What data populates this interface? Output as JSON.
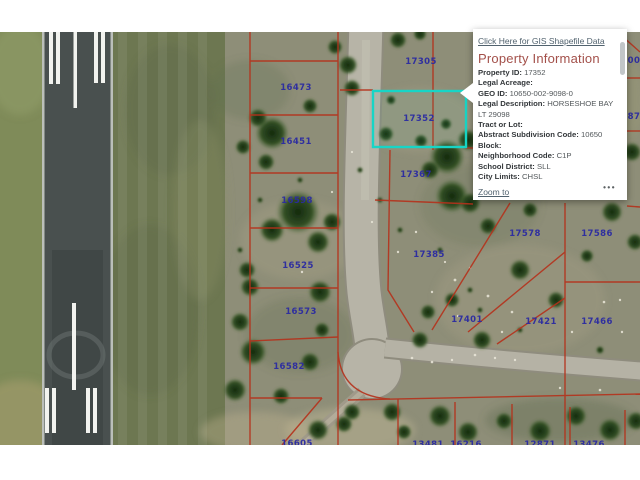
{
  "map": {
    "top_link": {
      "label": "Click Here for GIS Shapefile Data"
    },
    "highlight_color": "#17d5c6",
    "parcel_line_color": "#b5311b",
    "label_color": "#2b2ba2",
    "parcel_labels": [
      {
        "text": "16426",
        "x": 281,
        "y": 30
      },
      {
        "text": "16473",
        "x": 296,
        "y": 88
      },
      {
        "text": "16451",
        "x": 296,
        "y": 142
      },
      {
        "text": "16598",
        "x": 297,
        "y": 201
      },
      {
        "text": "16525",
        "x": 298,
        "y": 266
      },
      {
        "text": "16573",
        "x": 301,
        "y": 312
      },
      {
        "text": "16582",
        "x": 289,
        "y": 367
      },
      {
        "text": "16605",
        "x": 297,
        "y": 444
      },
      {
        "text": "17305",
        "x": 421,
        "y": 62
      },
      {
        "text": "17352",
        "x": 419,
        "y": 119
      },
      {
        "text": "17367",
        "x": 416,
        "y": 175
      },
      {
        "text": "17385",
        "x": 429,
        "y": 255
      },
      {
        "text": "17578",
        "x": 525,
        "y": 234
      },
      {
        "text": "17586",
        "x": 597,
        "y": 234
      },
      {
        "text": "17401",
        "x": 467,
        "y": 320
      },
      {
        "text": "17421",
        "x": 541,
        "y": 322
      },
      {
        "text": "17466",
        "x": 597,
        "y": 322
      },
      {
        "text": "00",
        "x": 634,
        "y": 61
      },
      {
        "text": "87",
        "x": 634,
        "y": 117
      },
      {
        "text": "13481",
        "x": 428,
        "y": 445
      },
      {
        "text": "16216",
        "x": 466,
        "y": 445
      },
      {
        "text": "12871",
        "x": 540,
        "y": 445
      },
      {
        "text": "13476",
        "x": 589,
        "y": 445
      }
    ]
  },
  "popup": {
    "title": "Property Information",
    "fields": [
      {
        "label": "Property ID:",
        "value": "17352"
      },
      {
        "label": "Legal Acreage:",
        "value": ""
      },
      {
        "label": "GEO ID:",
        "value": "10650-002-9098-0"
      },
      {
        "label": "Legal Description:",
        "value": "HORSESHOE BAY LT 29098"
      },
      {
        "label": "Tract or Lot:",
        "value": ""
      },
      {
        "label": "Abstract Subdivision Code:",
        "value": "10650"
      },
      {
        "label": "Block:",
        "value": ""
      },
      {
        "label": "Neighborhood Code:",
        "value": "C1P"
      },
      {
        "label": "School District:",
        "value": "SLL"
      },
      {
        "label": "City Limits:",
        "value": "CHSL"
      }
    ],
    "zoom_to_label": "Zoom to",
    "menu_icon_glyph": "•••"
  }
}
